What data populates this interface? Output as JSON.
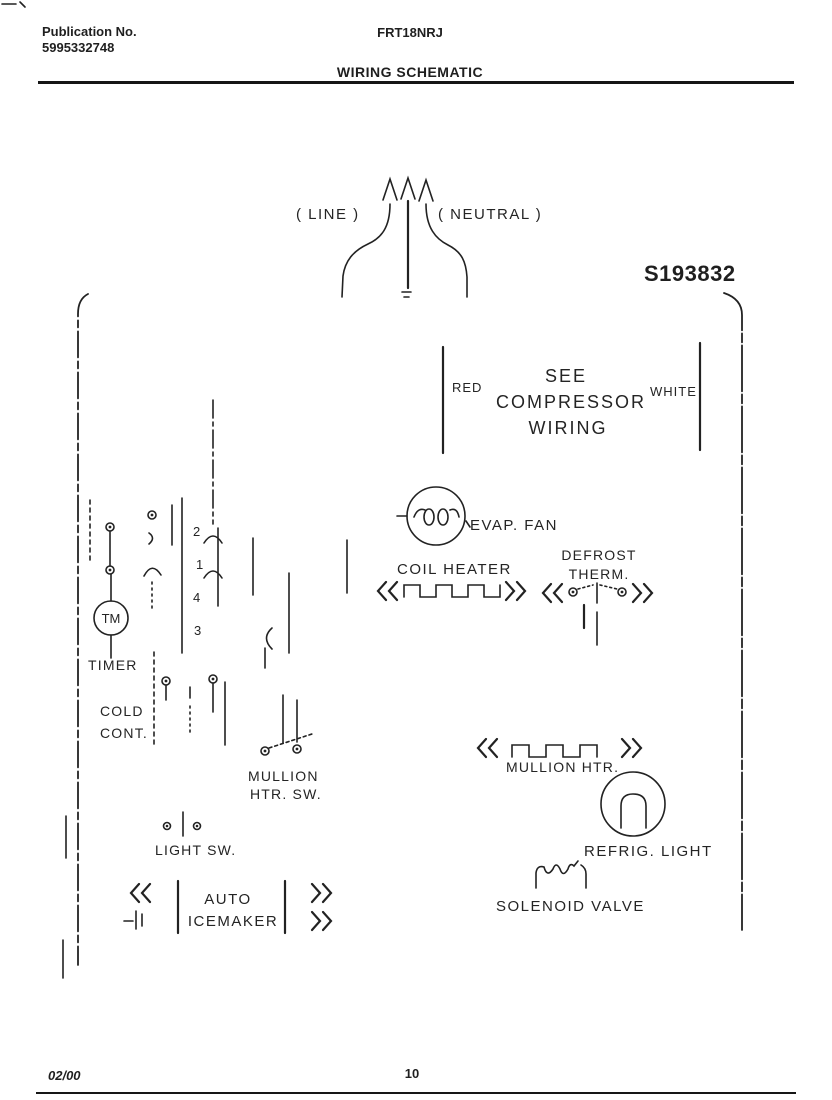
{
  "header": {
    "publication_label": "Publication No.",
    "publication_number": "5995332748",
    "model": "FRT18NRJ",
    "title": "WIRING SCHEMATIC"
  },
  "schematic": {
    "number": "S193832",
    "power": {
      "line": "( LINE )",
      "neutral": "( NEUTRAL )"
    },
    "compressor": {
      "left_wire": "RED",
      "right_wire": "WHITE",
      "note1": "SEE",
      "note2": "COMPRESSOR",
      "note3": "WIRING"
    },
    "components": {
      "evap_fan": "EVAP. FAN",
      "coil_heater": "COIL HEATER",
      "defrost1": "DEFROST",
      "defrost2": "THERM.",
      "timer": "TIMER",
      "timer_motor": "TM",
      "cold1": "COLD",
      "cold2": "CONT.",
      "mullion_sw1": "MULLION",
      "mullion_sw2": "HTR. SW.",
      "light_sw": "LIGHT SW.",
      "icemaker1": "AUTO",
      "icemaker2": "ICEMAKER",
      "mullion_htr": "MULLION HTR.",
      "refrig_light": "REFRIG. LIGHT",
      "solenoid": "SOLENOID VALVE"
    },
    "terminals": [
      "2",
      "1",
      "4",
      "3"
    ],
    "glyphs": {
      "connector_left": "«",
      "connector_right": "»"
    }
  },
  "footer": {
    "date": "02/00",
    "page": "10"
  }
}
